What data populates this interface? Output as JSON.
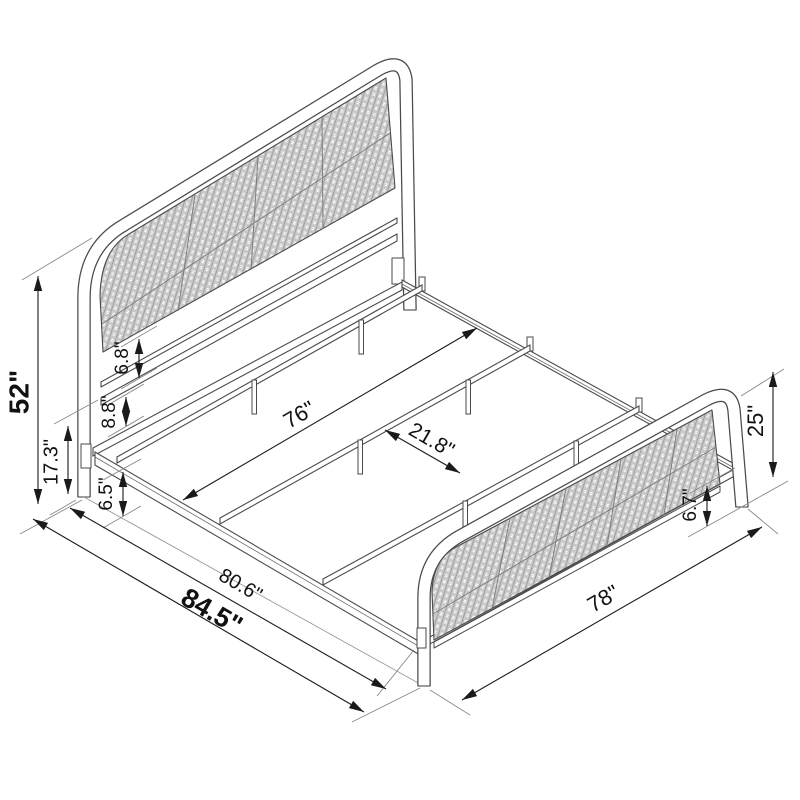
{
  "figure": {
    "kind": "isometric-line-drawing",
    "subject": "bed frame with cane headboard and footboard"
  },
  "dim_labels": {
    "headboard_height": "52\"",
    "headboard_lower_height": "17.3\"",
    "panel_bottom_gap": "6.8\"",
    "rail_gap": "8.8\"",
    "floor_clearance": "6.5\"",
    "slat_length": "76\"",
    "slat_spacing": "21.8\"",
    "frame_length": "80.6\"",
    "overall_length": "84.5\"",
    "bed_width": "78\"",
    "footboard_height": "25\"",
    "footboard_clearance": "6.7\""
  },
  "colors": {
    "background": "#ffffff",
    "outline": "#4a4a4a",
    "dimension_line": "#1a1a1a",
    "extension_line": "#8a8a8a",
    "cane_fill": "#c9c9c9",
    "label_text": "#111111"
  }
}
